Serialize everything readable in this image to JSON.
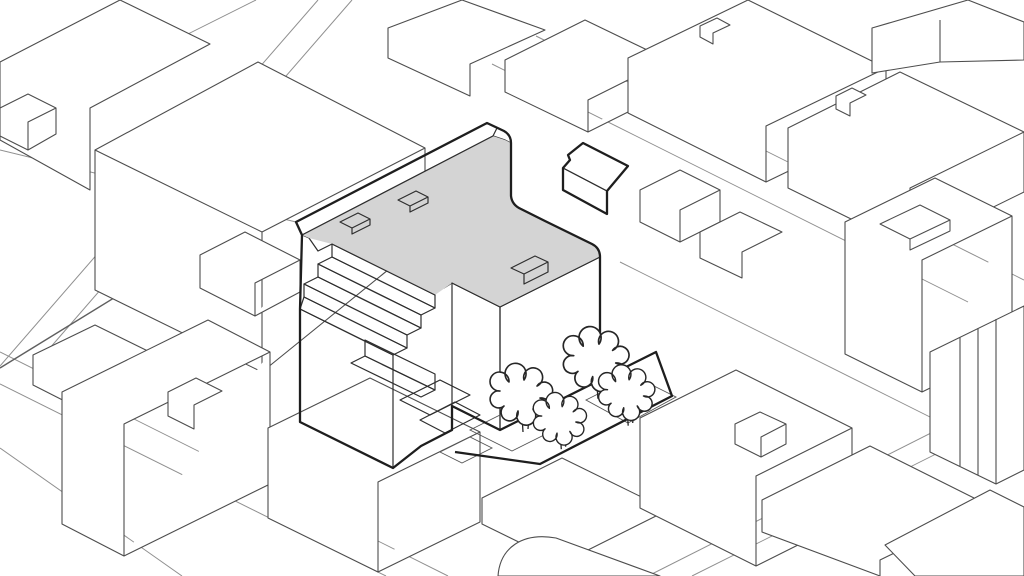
{
  "scene": {
    "type": "axonometric-massing-diagram",
    "highlighted_buildings": 2,
    "tree_count": 4,
    "text_labels": []
  },
  "colors": {
    "background": "#ffffff",
    "context_fill": "#ffffff",
    "context_line": "#4d4d4d",
    "site_outline": "#1e1e1e",
    "roof": "#d4d4d4",
    "roof_annex": "#cccccc",
    "parapet": "#909090",
    "facade_se_base": "#b2b2b2",
    "facade_se_line": "#d8d8d8",
    "facade_sw_base": "#9c9c9c",
    "facade_sw_line": "#c6c6c6",
    "terrace_tread": "#cfcfcf",
    "notch_wall": "#9a9a9a",
    "ground_strip": "#d7d7d7",
    "tree_fill": "#ffffff",
    "street_line": "#8f8f8f"
  }
}
